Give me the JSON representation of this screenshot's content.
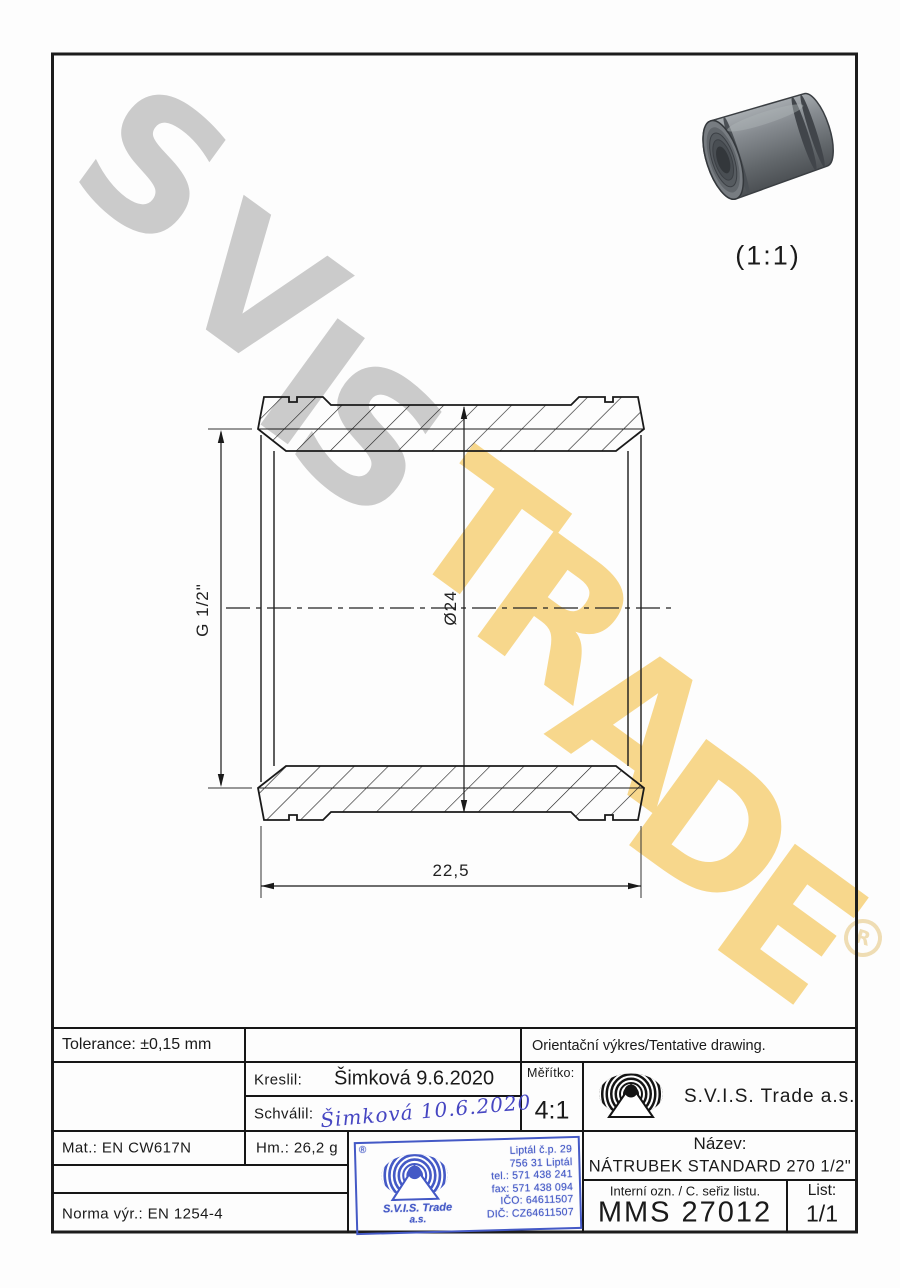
{
  "colors": {
    "watermark_gray": "#cbcbcb",
    "watermark_yellow": "#f7d78c",
    "stamp_blue": "#4459c6",
    "signature_blue": "#4646c2",
    "line_art": "#1a1a1a"
  },
  "watermark": {
    "letters": [
      "S",
      "V",
      "I",
      "S",
      "T",
      "R",
      "A",
      "D",
      "E"
    ],
    "registered": "R"
  },
  "view3d": {
    "scale_label": "(1:1)"
  },
  "dimensions": {
    "thread": "G 1/2\"",
    "diameter": "Ø24",
    "length": "22,5"
  },
  "titleblock": {
    "tolerance": "Tolerance: ±0,15 mm",
    "orientation_note": "Orientační výkres/Tentative drawing.",
    "drawn_label": "Kreslil:",
    "drawn_value": "Šimková 9.6.2020",
    "approved_label": "Schválil:",
    "approved_value": "Šimková 10.6.2020",
    "scale_label": "Měřítko:",
    "scale_value": "4:1",
    "company": "S.V.I.S. Trade a.s.",
    "material": "Mat.: EN CW617N",
    "weight": "Hm.: 26,2 g",
    "standard": "Norma výr.: EN 1254-4",
    "name_label": "Název:",
    "name_value": "NÁTRUBEK STANDARD 270 1/2\"",
    "internal_label": "Interní ozn. / C. seřiz listu.",
    "internal_value": "MMS 27012",
    "sheet_label": "List:",
    "sheet_value": "1/1"
  },
  "stamp": {
    "registered": "®",
    "company_line1": "S.V.I.S. Trade",
    "company_line2": "a.s.",
    "address": [
      "Liptál č.p. 29",
      "756 31 Liptál",
      "tel.: 571 438 241",
      "fax: 571 438 094",
      "IČO: 64611507",
      "DIČ: CZ64611507"
    ]
  }
}
